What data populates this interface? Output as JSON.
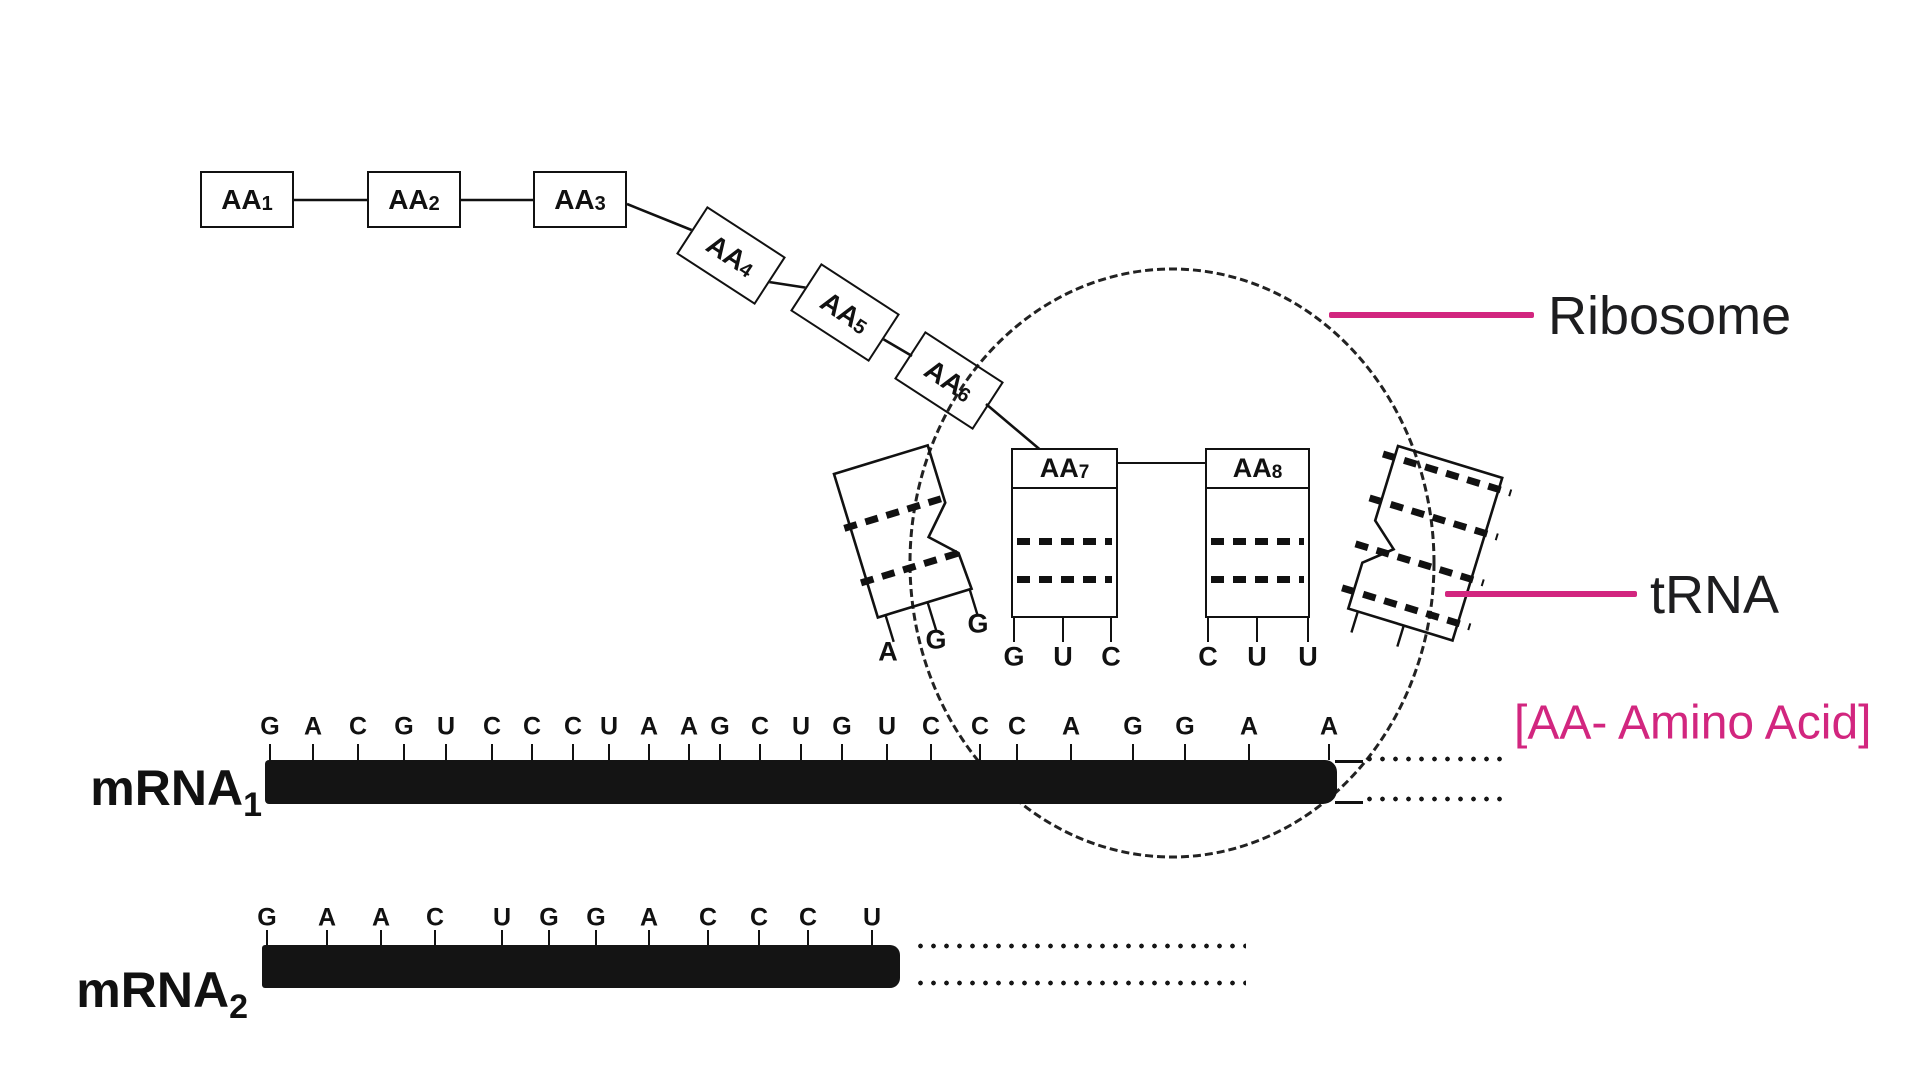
{
  "legend": {
    "ribosome_label": "Ribosome",
    "trna_label": "tRNA",
    "amino_acid_note": "[AA- Amino Acid]"
  },
  "colors": {
    "accent": "#d2267f",
    "ink": "#141414"
  },
  "amino_acid_chain": [
    {
      "base": "AA",
      "sub": "1"
    },
    {
      "base": "AA",
      "sub": "2"
    },
    {
      "base": "AA",
      "sub": "3"
    },
    {
      "base": "AA",
      "sub": "4"
    },
    {
      "base": "AA",
      "sub": "5"
    },
    {
      "base": "AA",
      "sub": "6"
    }
  ],
  "ribosome": {
    "left_trna_anticodon": [
      "A",
      "G",
      "G"
    ],
    "center_trnas": [
      {
        "base": "AA",
        "sub": "7",
        "anticodon": [
          "G",
          "U",
          "C"
        ]
      },
      {
        "base": "AA",
        "sub": "8",
        "anticodon": [
          "C",
          "U",
          "U"
        ]
      }
    ]
  },
  "mrna1": {
    "base": "mRNA",
    "sub": "1",
    "sequence": [
      "G",
      "A",
      "C",
      "G",
      "U",
      "C",
      "C",
      "C",
      "U",
      "A",
      "A",
      "G",
      "C",
      "U",
      "G",
      "U",
      "C",
      "C",
      "C",
      "A",
      "G",
      "G",
      "A",
      "A"
    ]
  },
  "mrna2": {
    "base": "mRNA",
    "sub": "2",
    "sequence": [
      "G",
      "A",
      "A",
      "C",
      "U",
      "G",
      "G",
      "A",
      "C",
      "C",
      "C",
      "U"
    ]
  }
}
